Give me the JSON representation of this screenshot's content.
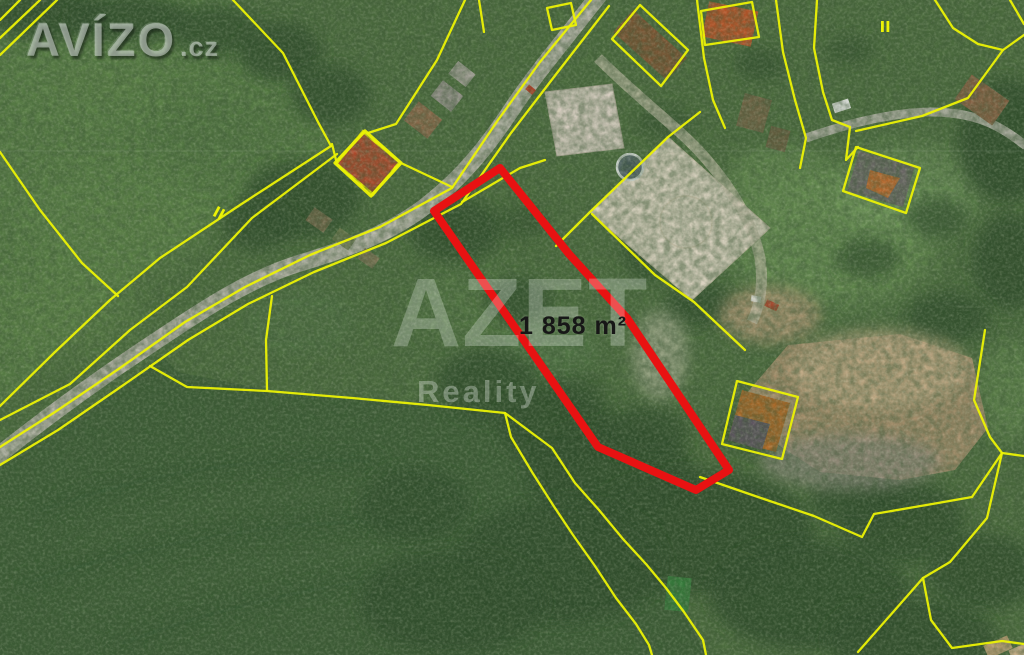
{
  "branding": {
    "portal_name": "AVÍZO",
    "portal_suffix": ".cz"
  },
  "watermark": {
    "agency_name": "AZET",
    "agency_subtitle": "Reality"
  },
  "plot": {
    "area_label": "1 858 m²",
    "label_pos": [
      519,
      312
    ],
    "color": "#e81212",
    "width": 8,
    "points": [
      [
        500,
        168
      ],
      [
        434,
        211
      ],
      [
        598,
        447
      ],
      [
        696,
        490
      ],
      [
        729,
        470
      ],
      [
        627,
        318
      ],
      [
        569,
        254
      ]
    ]
  },
  "cadastre": {
    "color": "#ecf205",
    "lines": [
      {
        "p": [
          [
            20,
            0
          ],
          [
            0,
            20
          ]
        ]
      },
      {
        "p": [
          [
            40,
            0
          ],
          [
            0,
            38
          ]
        ]
      },
      {
        "p": [
          [
            57,
            0
          ],
          [
            0,
            55
          ]
        ]
      },
      {
        "p": [
          [
            233,
            0
          ],
          [
            283,
            53
          ],
          [
            318,
            122
          ],
          [
            331,
            146
          ]
        ]
      },
      {
        "p": [
          [
            0,
            152
          ],
          [
            40,
            210
          ],
          [
            82,
            263
          ],
          [
            118,
            296
          ]
        ]
      },
      {
        "p": [
          [
            331,
            146
          ],
          [
            240,
            205
          ],
          [
            160,
            258
          ],
          [
            110,
            300
          ],
          [
            55,
            352
          ],
          [
            0,
            406
          ]
        ]
      },
      {
        "p": [
          [
            337,
            154
          ],
          [
            252,
            218
          ],
          [
            187,
            287
          ],
          [
            130,
            330
          ],
          [
            70,
            384
          ],
          [
            0,
            420
          ]
        ]
      },
      {
        "p": [
          [
            591,
            0
          ],
          [
            540,
            62
          ],
          [
            498,
            120
          ],
          [
            452,
            188
          ],
          [
            380,
            227
          ],
          [
            310,
            255
          ],
          [
            245,
            287
          ],
          [
            185,
            322
          ],
          [
            120,
            368
          ],
          [
            55,
            412
          ],
          [
            0,
            447
          ]
        ]
      },
      {
        "p": [
          [
            609,
            6
          ],
          [
            557,
            73
          ],
          [
            511,
            133
          ],
          [
            461,
            204
          ],
          [
            386,
            243
          ],
          [
            314,
            272
          ],
          [
            248,
            304
          ],
          [
            188,
            340
          ],
          [
            122,
            386
          ],
          [
            58,
            430
          ],
          [
            0,
            465
          ]
        ]
      },
      {
        "p": [
          [
            465,
            0
          ],
          [
            437,
            60
          ],
          [
            396,
            124
          ],
          [
            368,
            133
          ]
        ]
      },
      {
        "p": [
          [
            401,
            163
          ],
          [
            452,
            187
          ]
        ]
      },
      {
        "p": [
          [
            479,
            0
          ],
          [
            484,
            32
          ]
        ]
      },
      {
        "p": [
          [
            697,
            0
          ],
          [
            704,
            58
          ],
          [
            713,
            100
          ],
          [
            725,
            128
          ]
        ]
      },
      {
        "p": [
          [
            776,
            0
          ],
          [
            783,
            52
          ],
          [
            795,
            100
          ],
          [
            806,
            138
          ],
          [
            800,
            168
          ]
        ]
      },
      {
        "p": [
          [
            817,
            0
          ],
          [
            814,
            48
          ],
          [
            823,
            92
          ],
          [
            832,
            120
          ],
          [
            850,
            127
          ],
          [
            846,
            160
          ],
          [
            858,
            147
          ]
        ]
      },
      {
        "p": [
          [
            1024,
            35
          ],
          [
            1003,
            50
          ],
          [
            968,
            98
          ],
          [
            922,
            116
          ],
          [
            856,
            131
          ]
        ]
      },
      {
        "p": [
          [
            935,
            0
          ],
          [
            953,
            28
          ],
          [
            978,
            44
          ],
          [
            1003,
            50
          ]
        ]
      },
      {
        "p": [
          [
            1010,
            0
          ],
          [
            1024,
            24
          ]
        ]
      },
      {
        "p": [
          [
            985,
            330
          ],
          [
            974,
            400
          ],
          [
            990,
            437
          ],
          [
            1002,
            453
          ]
        ]
      },
      {
        "p": [
          [
            700,
            477
          ],
          [
            758,
            497
          ],
          [
            814,
            516
          ],
          [
            862,
            537
          ],
          [
            874,
            514
          ],
          [
            938,
            503
          ],
          [
            972,
            497
          ],
          [
            1002,
            453
          ],
          [
            1024,
            456
          ]
        ]
      },
      {
        "p": [
          [
            1002,
            453
          ],
          [
            987,
            518
          ],
          [
            950,
            562
          ],
          [
            923,
            578
          ],
          [
            858,
            652
          ]
        ]
      },
      {
        "p": [
          [
            923,
            578
          ],
          [
            931,
            620
          ],
          [
            952,
            648
          ],
          [
            1002,
            641
          ],
          [
            1024,
            644
          ]
        ]
      },
      {
        "p": [
          [
            150,
            366
          ],
          [
            187,
            387
          ],
          [
            267,
            391
          ],
          [
            352,
            398
          ],
          [
            428,
            405
          ],
          [
            505,
            413
          ],
          [
            552,
            448
          ],
          [
            575,
            483
          ],
          [
            599,
            510
          ],
          [
            623,
            539
          ],
          [
            646,
            564
          ],
          [
            666,
            588
          ],
          [
            684,
            612
          ],
          [
            703,
            640
          ],
          [
            706,
            655
          ]
        ]
      },
      {
        "p": [
          [
            505,
            413
          ],
          [
            511,
            437
          ],
          [
            532,
            472
          ],
          [
            553,
            505
          ],
          [
            573,
            535
          ],
          [
            595,
            566
          ],
          [
            616,
            598
          ],
          [
            636,
            624
          ],
          [
            649,
            645
          ],
          [
            652,
            655
          ]
        ]
      },
      {
        "p": [
          [
            272,
            296
          ],
          [
            266,
            340
          ],
          [
            267,
            390
          ]
        ]
      },
      {
        "p": [
          [
            556,
            246
          ],
          [
            590,
            212
          ],
          [
            668,
            137
          ],
          [
            700,
            112
          ]
        ]
      },
      {
        "p": [
          [
            592,
            214
          ],
          [
            655,
            275
          ],
          [
            694,
            302
          ],
          [
            745,
            350
          ]
        ]
      },
      {
        "p": [
          [
            856,
            147
          ],
          [
            920,
            168
          ],
          [
            906,
            213
          ],
          [
            843,
            191
          ]
        ],
        "closed": true
      },
      {
        "p": [
          [
            722,
            444
          ],
          [
            737,
            381
          ],
          [
            798,
            397
          ],
          [
            782,
            459
          ]
        ],
        "closed": true
      },
      {
        "p": [
          [
            332,
            144
          ],
          [
            336,
            160
          ]
        ]
      },
      {
        "p": [
          [
            547,
            8
          ],
          [
            571,
            3
          ],
          [
            576,
            25
          ],
          [
            552,
            30
          ]
        ],
        "closed": true
      },
      {
        "p": [
          [
            705,
            45
          ],
          [
            701,
            11
          ],
          [
            752,
            2
          ],
          [
            759,
            37
          ]
        ],
        "closed": true
      },
      {
        "p": [
          [
            612,
            39
          ],
          [
            640,
            5
          ],
          [
            688,
            50
          ],
          [
            661,
            86
          ]
        ],
        "closed": true
      },
      {
        "p": [
          [
            462,
            202
          ],
          [
            520,
            168
          ],
          [
            545,
            160
          ]
        ]
      },
      {
        "p": [
          [
            365,
            131
          ],
          [
            401,
            163
          ],
          [
            371,
            196
          ],
          [
            335,
            163
          ]
        ],
        "closed": true,
        "w": 3.2
      }
    ],
    "symbols": [
      {
        "name": "parcel-double-tick",
        "x": 218,
        "y": 206,
        "rot": 28
      },
      {
        "name": "parcel-double-tick",
        "x": 881,
        "y": 21,
        "rot": 0
      }
    ]
  },
  "colors": {
    "plot_outline_red": "#e81212",
    "cadastral_yellow": "#ecf205",
    "field_green": "#587d45",
    "meadow_dark_green": "#3c5c35",
    "road_gray": "#b2b1a5",
    "court_sand": "#d9d1bf",
    "dirt_brown": "#a8906e"
  }
}
